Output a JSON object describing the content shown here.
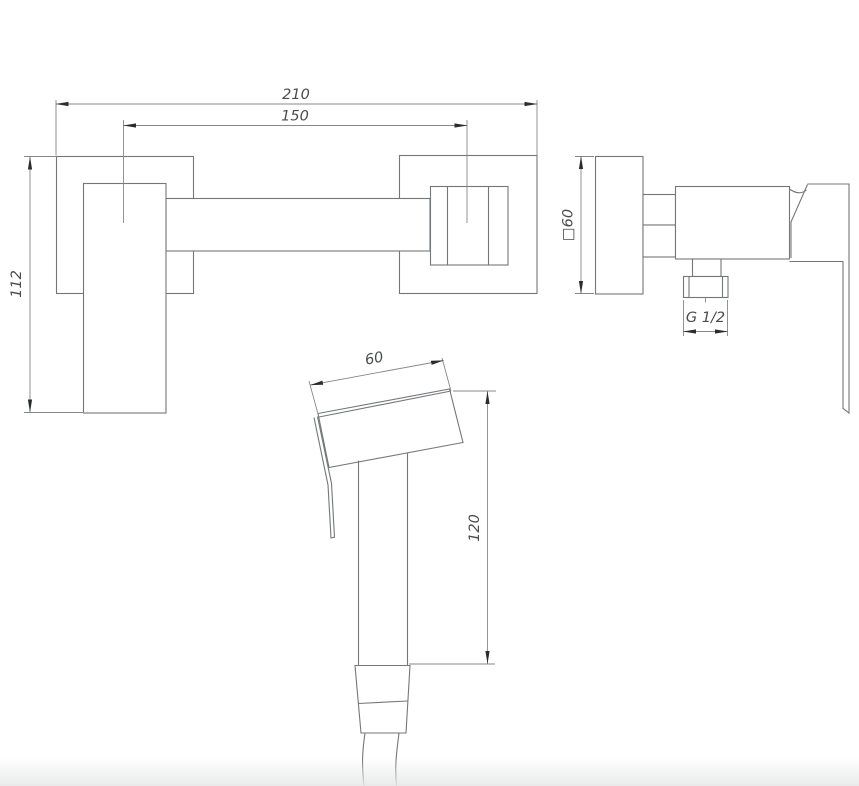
{
  "colors": {
    "background": "#ffffff",
    "object_line": "#74777a",
    "dimension_line": "#85888b",
    "arrow": "#2a2c2e",
    "text": "#494b4d",
    "bottom_fade": "#e7e8e8"
  },
  "views": {
    "front": {
      "label": "front-view",
      "dim_overall_width": "210",
      "dim_mounting_distance": "150",
      "dim_height": "112"
    },
    "side": {
      "label": "side-view",
      "dim_plate": "□60",
      "dim_thread": "G 1/2"
    },
    "sprayer": {
      "label": "sprayer-view",
      "dim_head_length": "60",
      "dim_handle_length": "120"
    }
  }
}
